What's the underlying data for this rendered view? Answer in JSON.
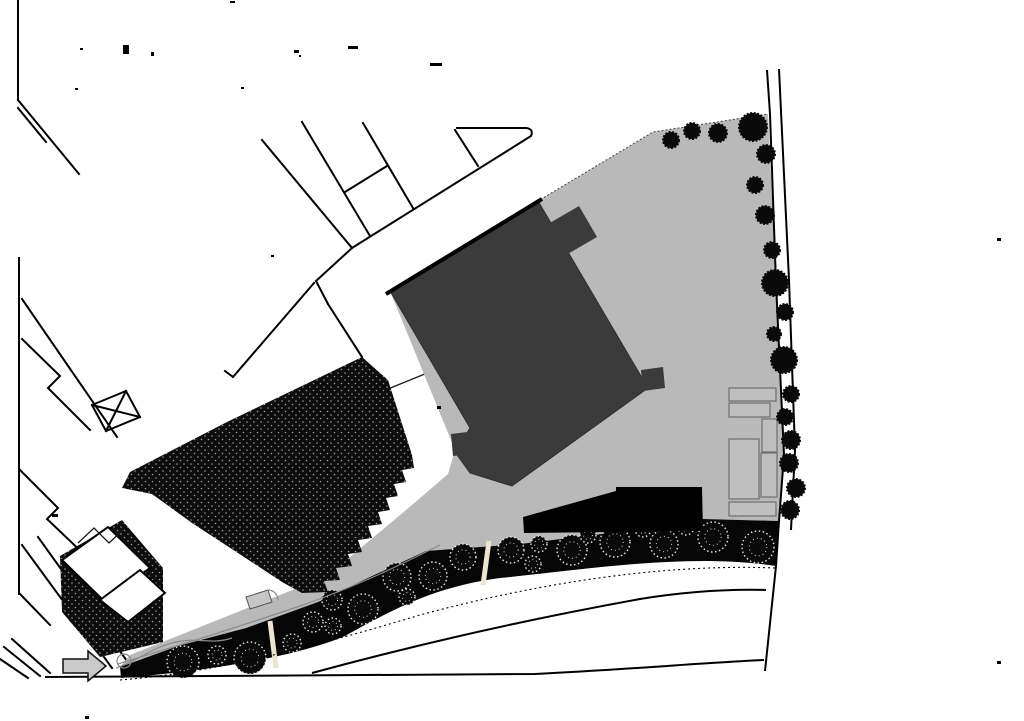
{
  "canvas": {
    "width": 1024,
    "height": 721
  },
  "colors": {
    "background": "#ffffff",
    "site_ground": "#b9b9b9",
    "proposed_building": "#3b3b3b",
    "existing_building_fill": "#0d0d0d",
    "stipple_dot": "#9b9b9b",
    "planting_strip": "#060606",
    "low_building_bar": "#000000",
    "tree_dark": "#0a0a0a",
    "tree_sketch_outline": "#e8e8e8",
    "divider": "#ece4d0",
    "arrow_fill": "#c9c9c9",
    "service_rect_stroke": "#6f6f6f",
    "line_work": "#000000"
  },
  "trees": {
    "canopy_row": [
      [
        183,
        662,
        16
      ],
      [
        217,
        655,
        9
      ],
      [
        250,
        658,
        16
      ],
      [
        292,
        643,
        9
      ],
      [
        313,
        622,
        10
      ],
      [
        333,
        626,
        8
      ],
      [
        332,
        600,
        10
      ],
      [
        363,
        609,
        15
      ],
      [
        397,
        577,
        14
      ],
      [
        407,
        597,
        8
      ],
      [
        433,
        576,
        14
      ],
      [
        463,
        557,
        13
      ],
      [
        511,
        550,
        13
      ],
      [
        539,
        544,
        8
      ],
      [
        533,
        564,
        8
      ],
      [
        572,
        550,
        15
      ],
      [
        588,
        535,
        8
      ],
      [
        615,
        542,
        15
      ],
      [
        643,
        529,
        8
      ],
      [
        664,
        544,
        14
      ],
      [
        686,
        527,
        8
      ],
      [
        713,
        537,
        15
      ],
      [
        758,
        547,
        16
      ]
    ],
    "boundary_row": [
      [
        671,
        140,
        8
      ],
      [
        692,
        131,
        8
      ],
      [
        718,
        133,
        9
      ],
      [
        753,
        127,
        14
      ],
      [
        766,
        154,
        9
      ],
      [
        755,
        185,
        8
      ],
      [
        765,
        215,
        9
      ],
      [
        772,
        250,
        8
      ],
      [
        775,
        283,
        13
      ],
      [
        785,
        312,
        8
      ],
      [
        774,
        334,
        7
      ],
      [
        784,
        360,
        13
      ],
      [
        791,
        394,
        8
      ],
      [
        785,
        417,
        8
      ],
      [
        791,
        440,
        9
      ],
      [
        789,
        463,
        9
      ],
      [
        796,
        488,
        9
      ],
      [
        790,
        510,
        9
      ]
    ]
  },
  "dividers": [
    [
      270,
      621,
      276,
      668
    ],
    [
      489,
      541,
      483,
      585
    ]
  ],
  "marks": [
    [
      80,
      48,
      3,
      2
    ],
    [
      123,
      45,
      6,
      9
    ],
    [
      151,
      52,
      3,
      4
    ],
    [
      230,
      1,
      5,
      2
    ],
    [
      294,
      50,
      5,
      3
    ],
    [
      299,
      55,
      2,
      2
    ],
    [
      348,
      46,
      10,
      3
    ],
    [
      430,
      63,
      12,
      3
    ],
    [
      75,
      88,
      3,
      2
    ],
    [
      241,
      87,
      3,
      2
    ],
    [
      271,
      255,
      3,
      2
    ],
    [
      52,
      514,
      6,
      3
    ],
    [
      437,
      406,
      4,
      3
    ],
    [
      997,
      238,
      4,
      3
    ],
    [
      997,
      661,
      4,
      3
    ],
    [
      85,
      716,
      4,
      3
    ]
  ]
}
